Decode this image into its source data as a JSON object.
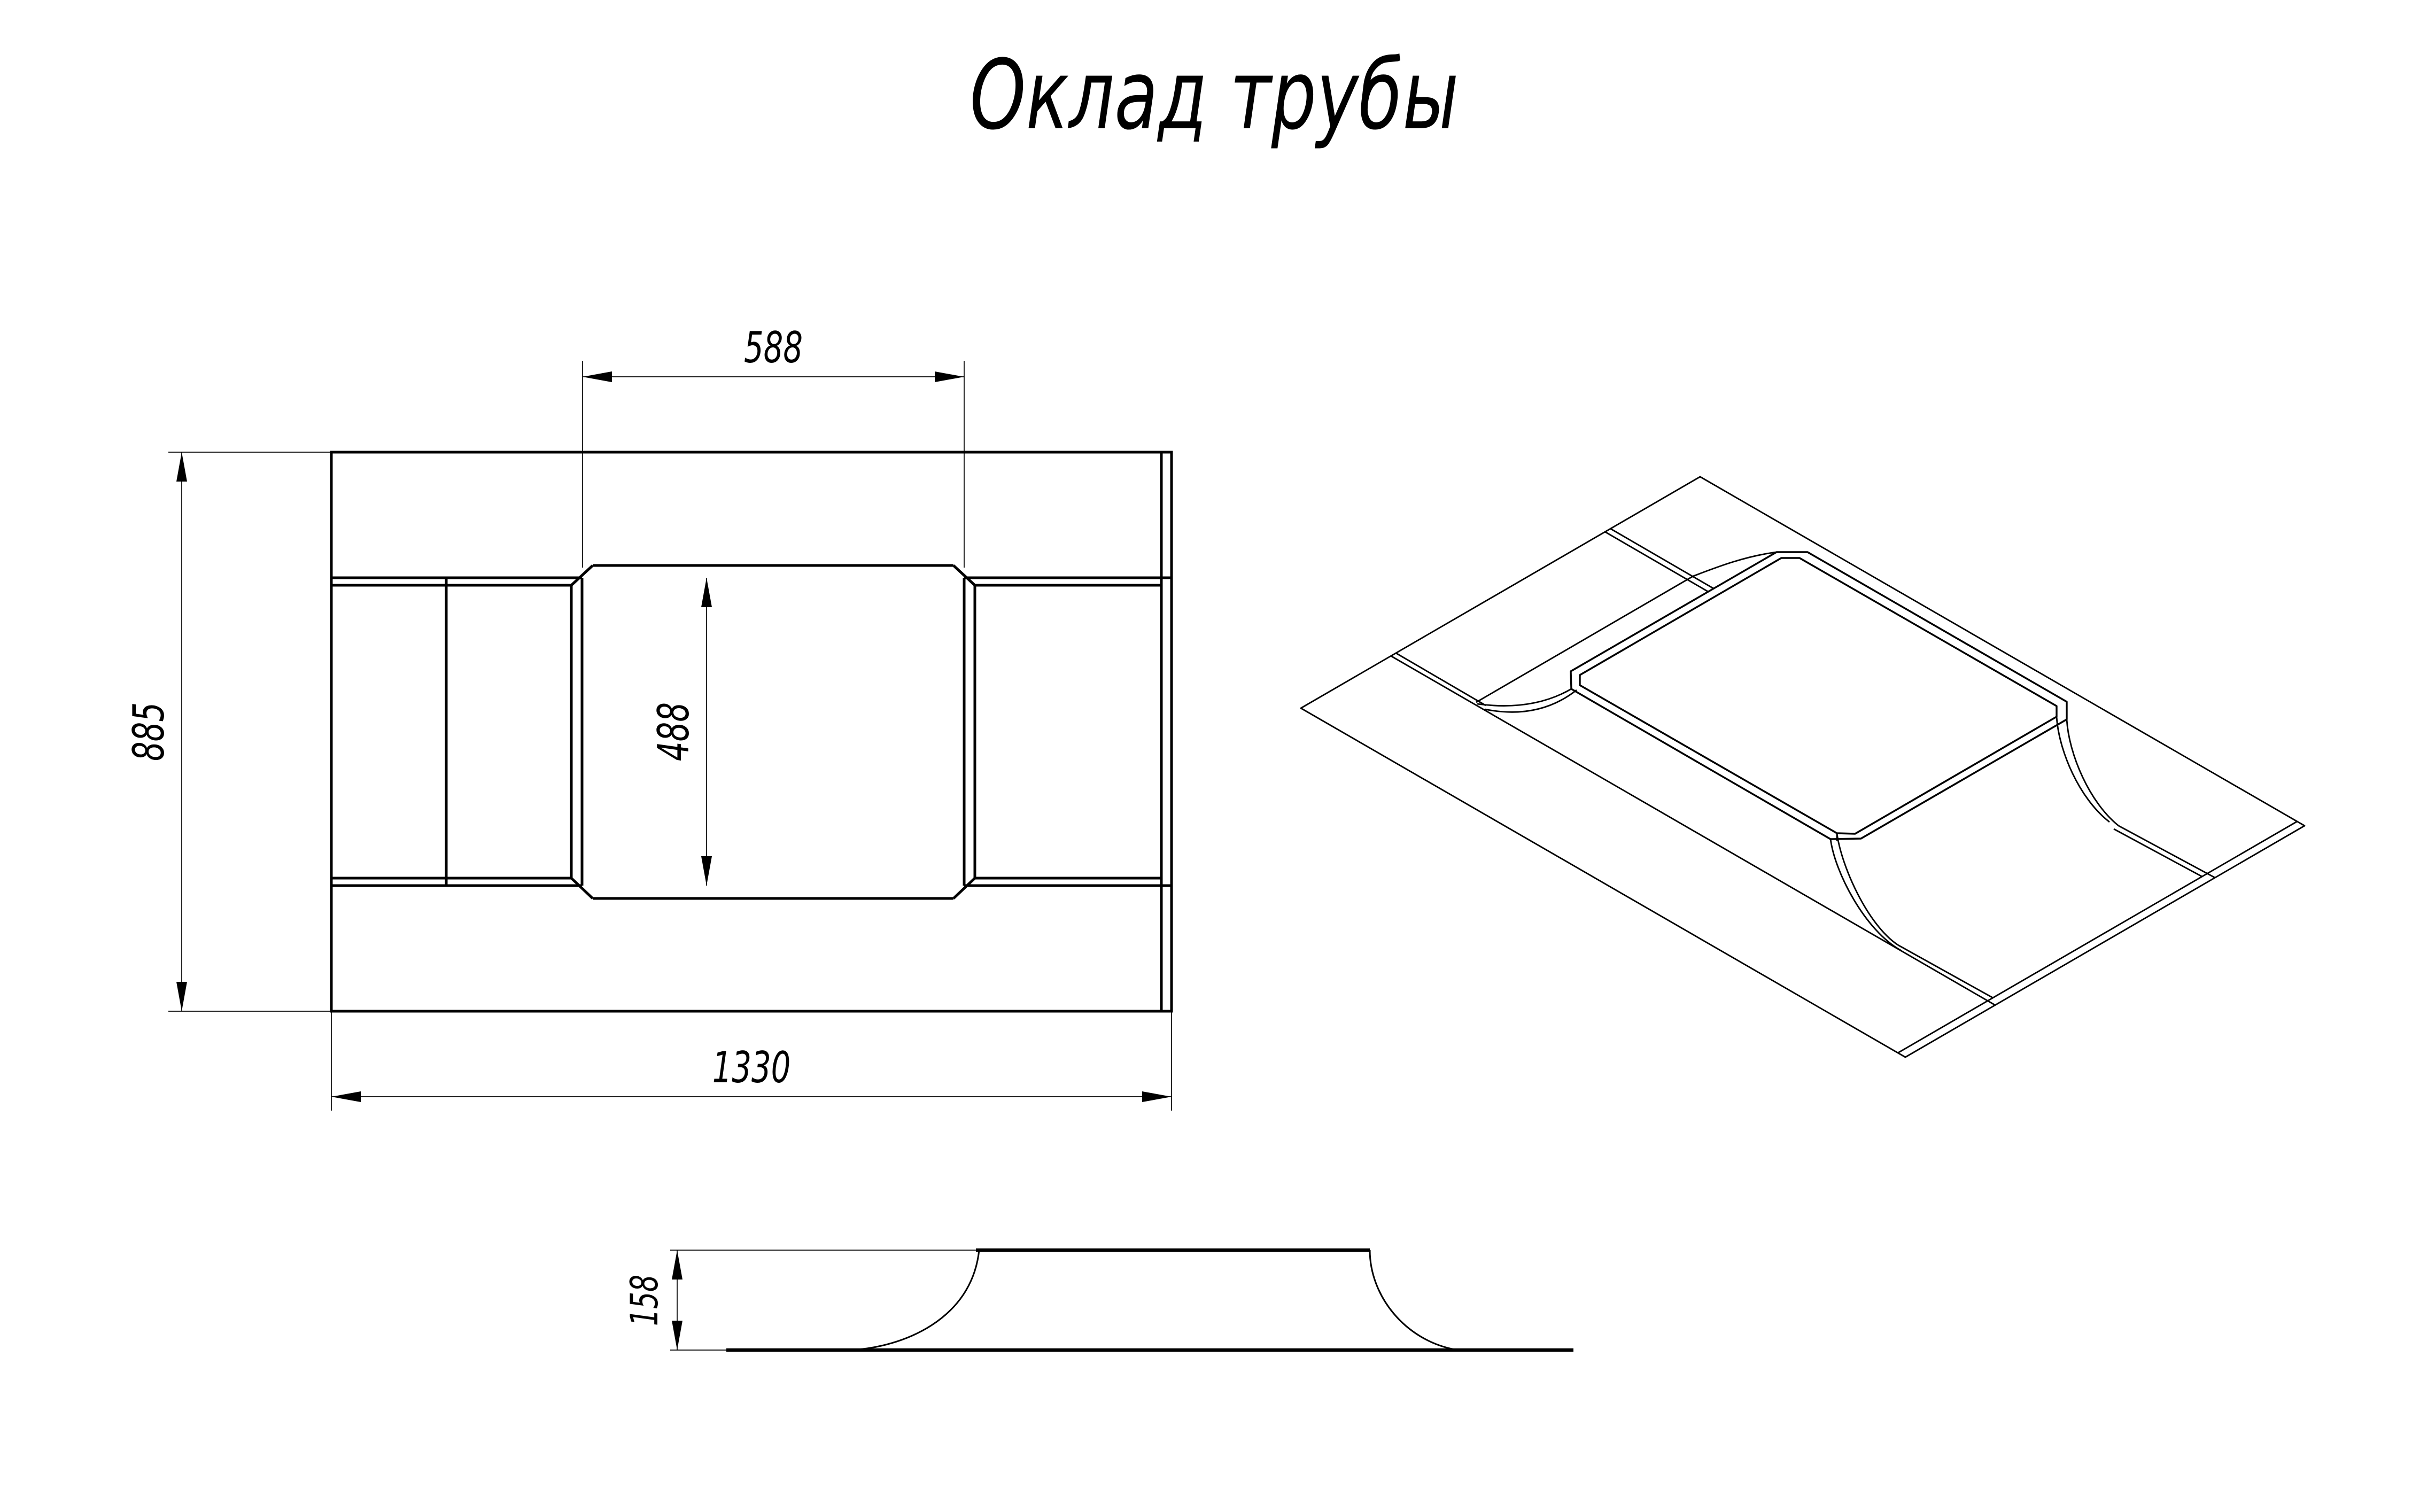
{
  "title": "Оклад трубы",
  "colors": {
    "ink": "#000000",
    "background": "#ffffff"
  },
  "views": {
    "plan": {
      "dim_opening_width": "588",
      "dim_opening_height": "488",
      "dim_plate_height": "885",
      "dim_plate_width": "1330"
    },
    "side": {
      "dim_profile_height": "158"
    }
  }
}
